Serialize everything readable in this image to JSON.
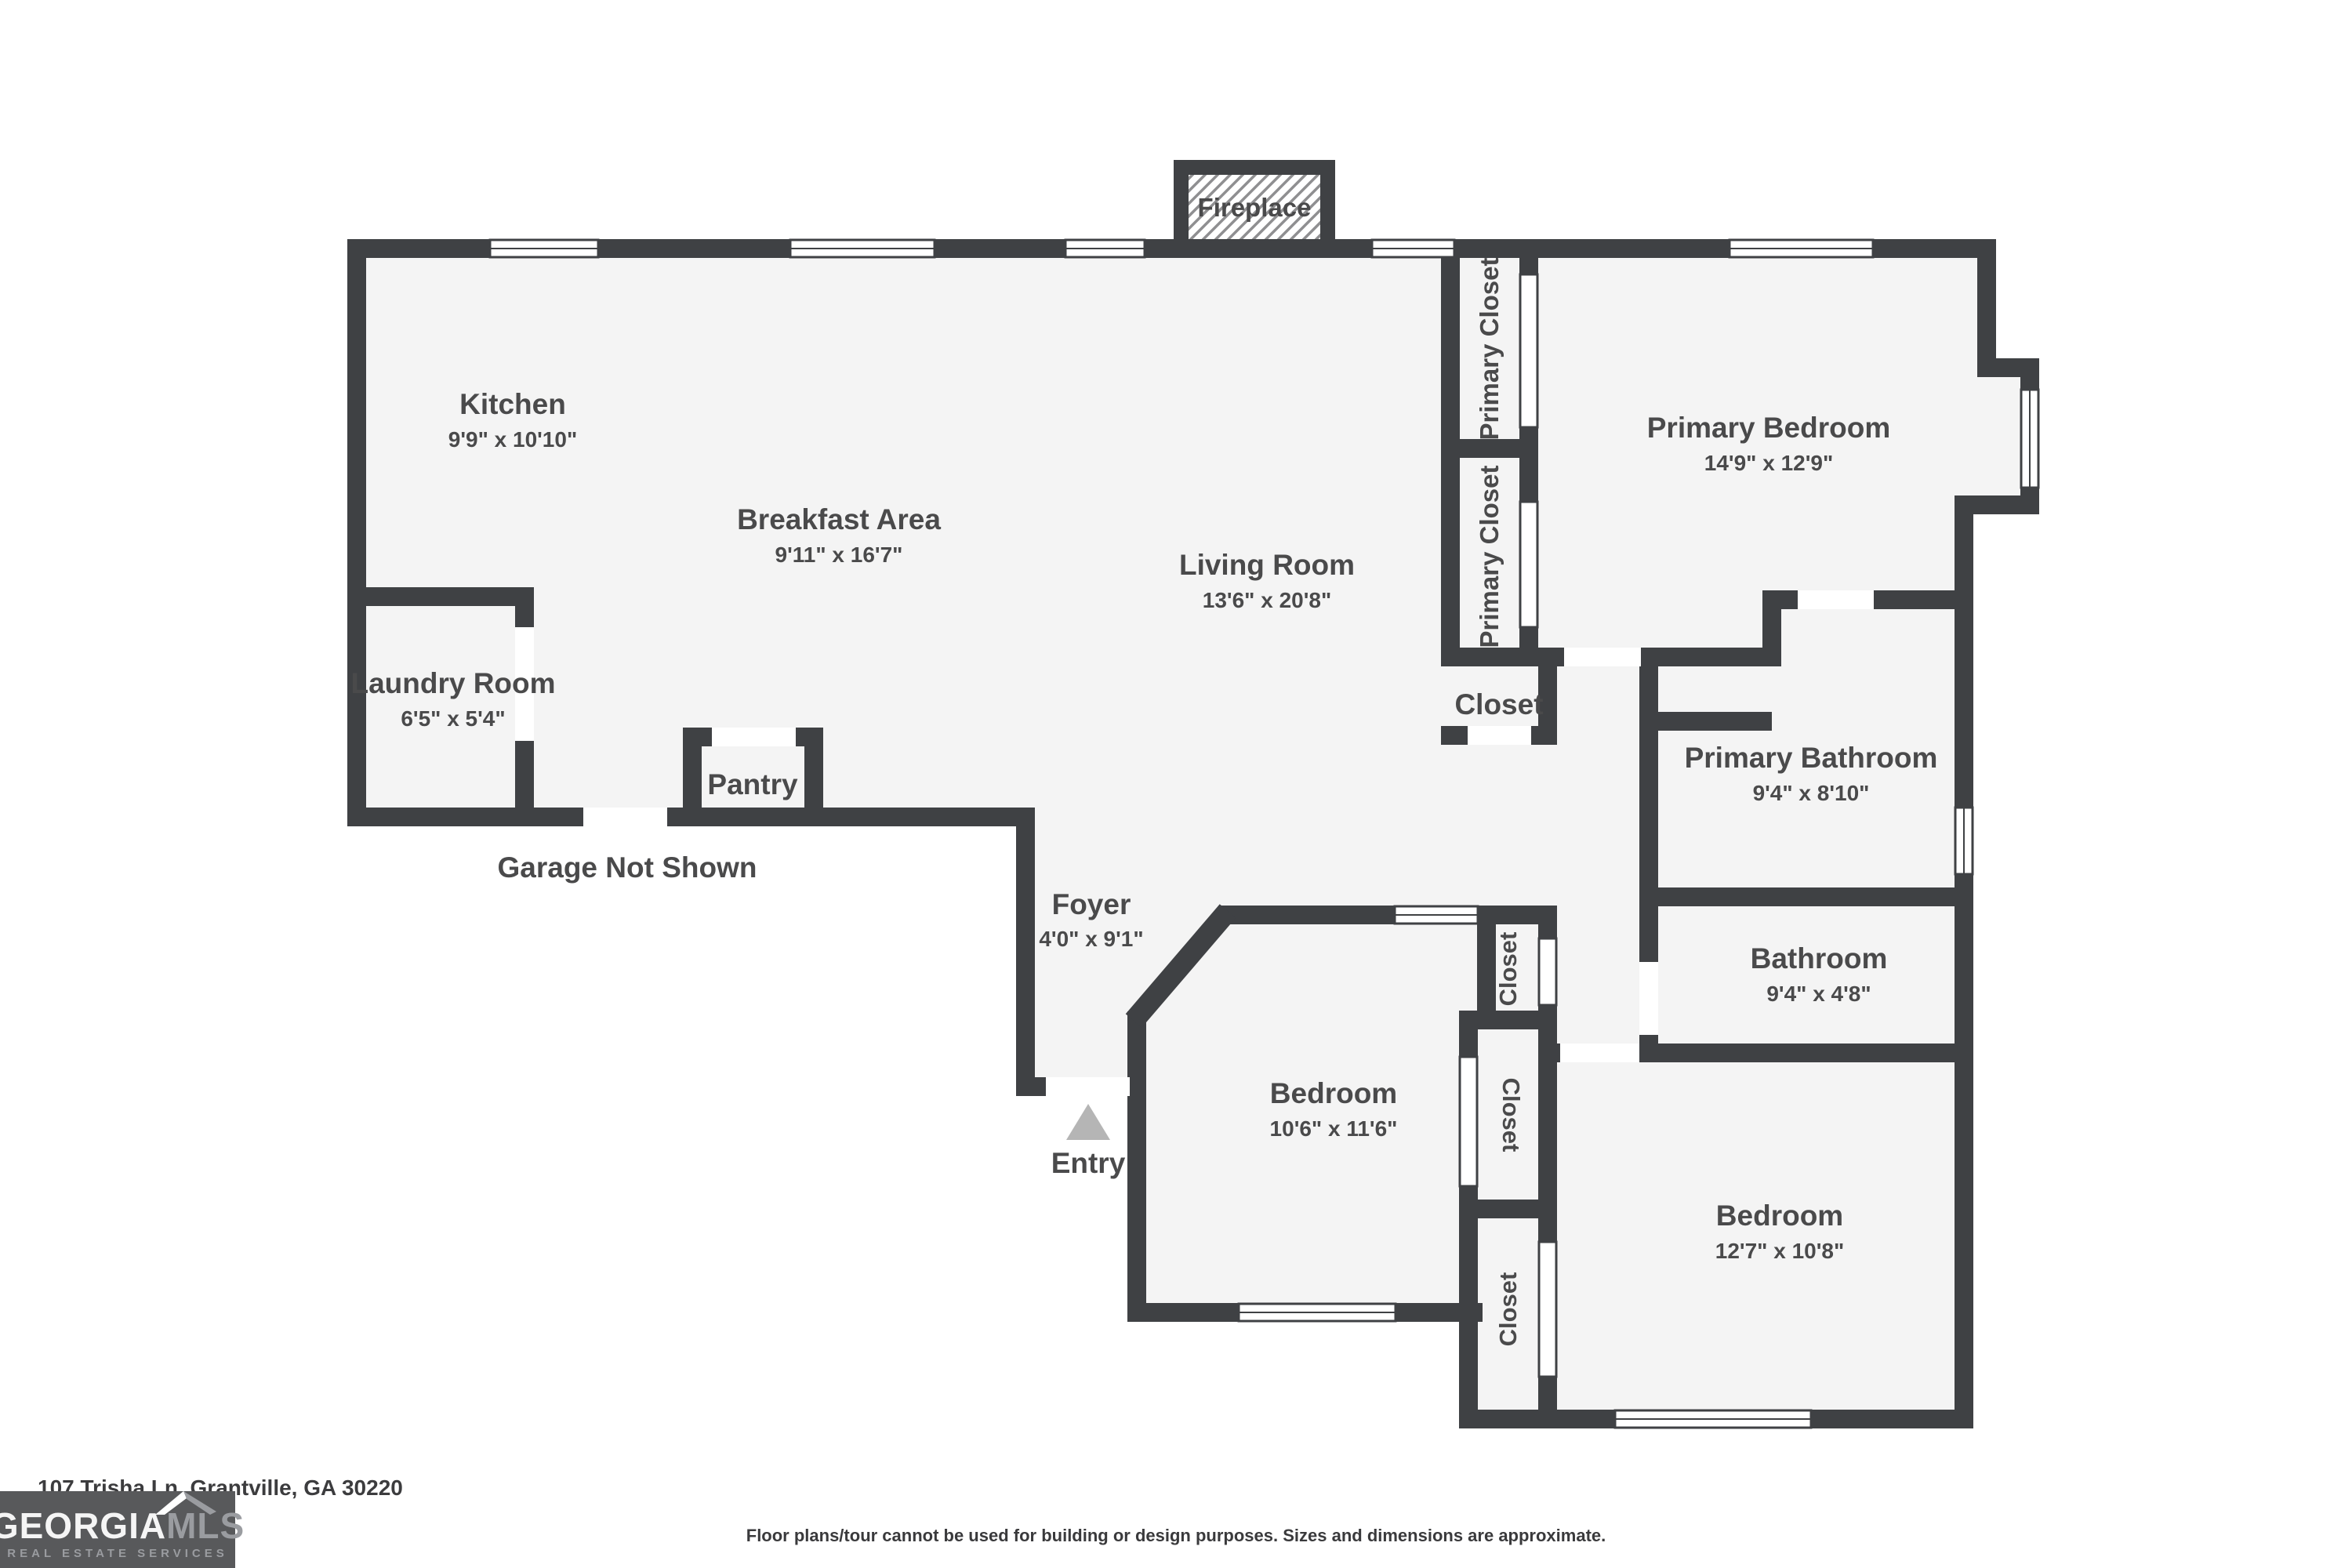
{
  "colors": {
    "wall": "#3f4144",
    "floor": "#f4f4f4",
    "label_text": "#4a4a4b",
    "entry_arrow": "#b5b5b5",
    "logo_bg": "#58595b",
    "logo_secondary": "#9a9ca0"
  },
  "plan": {
    "fireplace_label": "Fireplace",
    "garage_note": "Garage Not Shown",
    "entry_label": "Entry",
    "pantry_label": "Pantry",
    "hall_closet_label": "Closet",
    "rooms": [
      {
        "name": "Kitchen",
        "dims": "9'9\" x 10'10\""
      },
      {
        "name": "Breakfast Area",
        "dims": "9'11\" x 16'7\""
      },
      {
        "name": "Living Room",
        "dims": "13'6\" x 20'8\""
      },
      {
        "name": "Primary Bedroom",
        "dims": "14'9\" x 12'9\""
      },
      {
        "name": "Laundry Room",
        "dims": "6'5\" x 5'4\""
      },
      {
        "name": "Foyer",
        "dims": "4'0\" x 9'1\""
      },
      {
        "name": "Bedroom",
        "dims": "10'6\" x 11'6\""
      },
      {
        "name": "Primary Bathroom",
        "dims": "9'4\" x 8'10\""
      },
      {
        "name": "Bathroom",
        "dims": "9'4\" x 4'8\""
      },
      {
        "name": "Bedroom",
        "dims": "12'7\" x 10'8\""
      }
    ],
    "closets": [
      {
        "label": "Primary Closet"
      },
      {
        "label": "Primary Closet"
      },
      {
        "label": "Closet"
      },
      {
        "label": "Closet"
      },
      {
        "label": "Closet"
      }
    ]
  },
  "footer": {
    "address": "107 Trisha Ln, Grantville, GA 30220",
    "disclaimer": "Floor plans/tour cannot be used for building or design purposes. Sizes and dimensions are approximate."
  },
  "logo": {
    "name_primary": "GEORGIA",
    "name_secondary": "MLS",
    "tagline": "REAL ESTATE SERVICES"
  }
}
